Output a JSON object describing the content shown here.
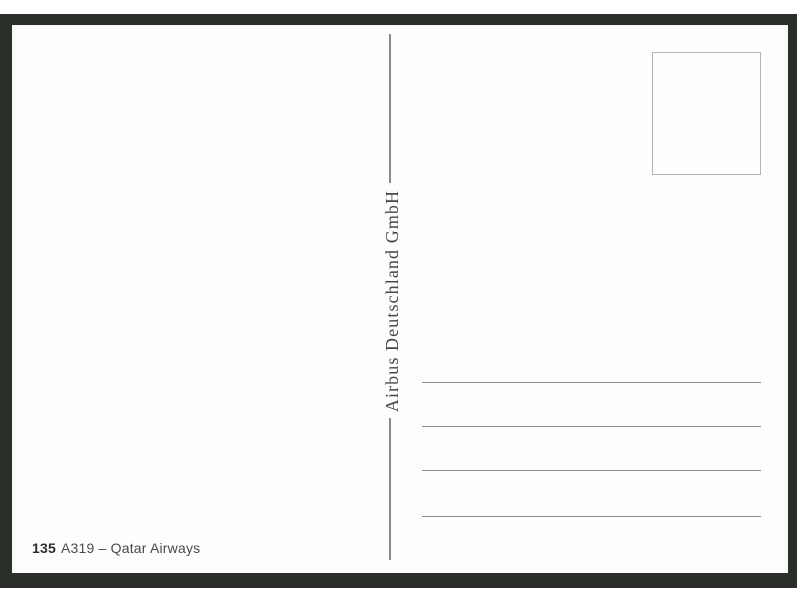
{
  "postcard": {
    "publisher_vertical_text": "Airbus Deutschland GmbH",
    "caption": {
      "number": "135",
      "title": "A319 – Qatar Airways"
    },
    "address_rule_count": 4,
    "stamp_box_text": ""
  },
  "colors": {
    "backdrop": "#2a2f29",
    "card": "#fdfdfd",
    "divider_line": "#8a8a8a",
    "address_rule": "#8f8f8f",
    "stamp_border": "#b4b4b4",
    "publisher_text": "#474747",
    "caption_number": "#2d2d2d",
    "caption_text": "#4a4a4a"
  }
}
